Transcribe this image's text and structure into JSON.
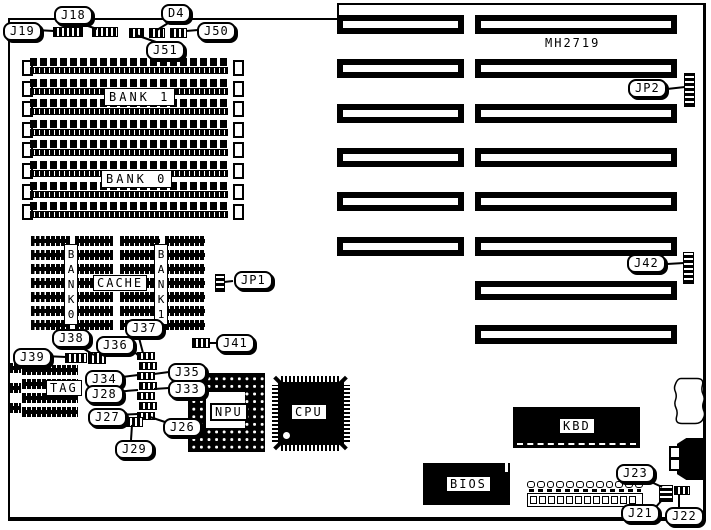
{
  "board_text": {
    "chipset": "MH2719"
  },
  "labels": {
    "j18": "J18",
    "j19": "J19",
    "d4": "D4",
    "j50": "J50",
    "j51": "J51",
    "jp2": "JP2",
    "j42": "J42",
    "jp1": "JP1",
    "j37": "J37",
    "j38": "J38",
    "j36": "J36",
    "j41": "J41",
    "j39": "J39",
    "j34": "J34",
    "j28": "J28",
    "j27": "J27",
    "j29": "J29",
    "j35": "J35",
    "j33": "J33",
    "j26": "J26",
    "j23": "J23",
    "j21": "J21",
    "j22": "J22"
  },
  "components": {
    "mem_bank1": "BANK 1",
    "mem_bank0": "BANK 0",
    "cache_bank0": "BANK0",
    "cache_bank1": "BANK1",
    "cache": "CACHE",
    "tag": "TAG",
    "npu": "NPU",
    "cpu": "CPU",
    "kbd": "KBD",
    "bios": "BIOS"
  },
  "structure": {
    "simm_rows": 8,
    "simm_clips_per_side": 8,
    "cache_blocks": 2,
    "cache_rows_per_block": 7,
    "cache_chips_per_row": 2,
    "tag_rows": 4,
    "tag_side_blocks": 3,
    "jumper_column_count": 7,
    "slot_rows": [
      {
        "left": true,
        "right": true
      },
      {
        "left": true,
        "right": true
      },
      {
        "left": true,
        "right": true
      },
      {
        "left": true,
        "right": true
      },
      {
        "left": true,
        "right": true
      },
      {
        "left": true,
        "right": true
      },
      {
        "left": false,
        "right": true
      },
      {
        "left": false,
        "right": true
      }
    ],
    "power_connector": {
      "top_pins": 12,
      "bottom_pins": 12
    }
  },
  "colors": {
    "board_bg": "#ffffff",
    "ink": "#000000"
  }
}
